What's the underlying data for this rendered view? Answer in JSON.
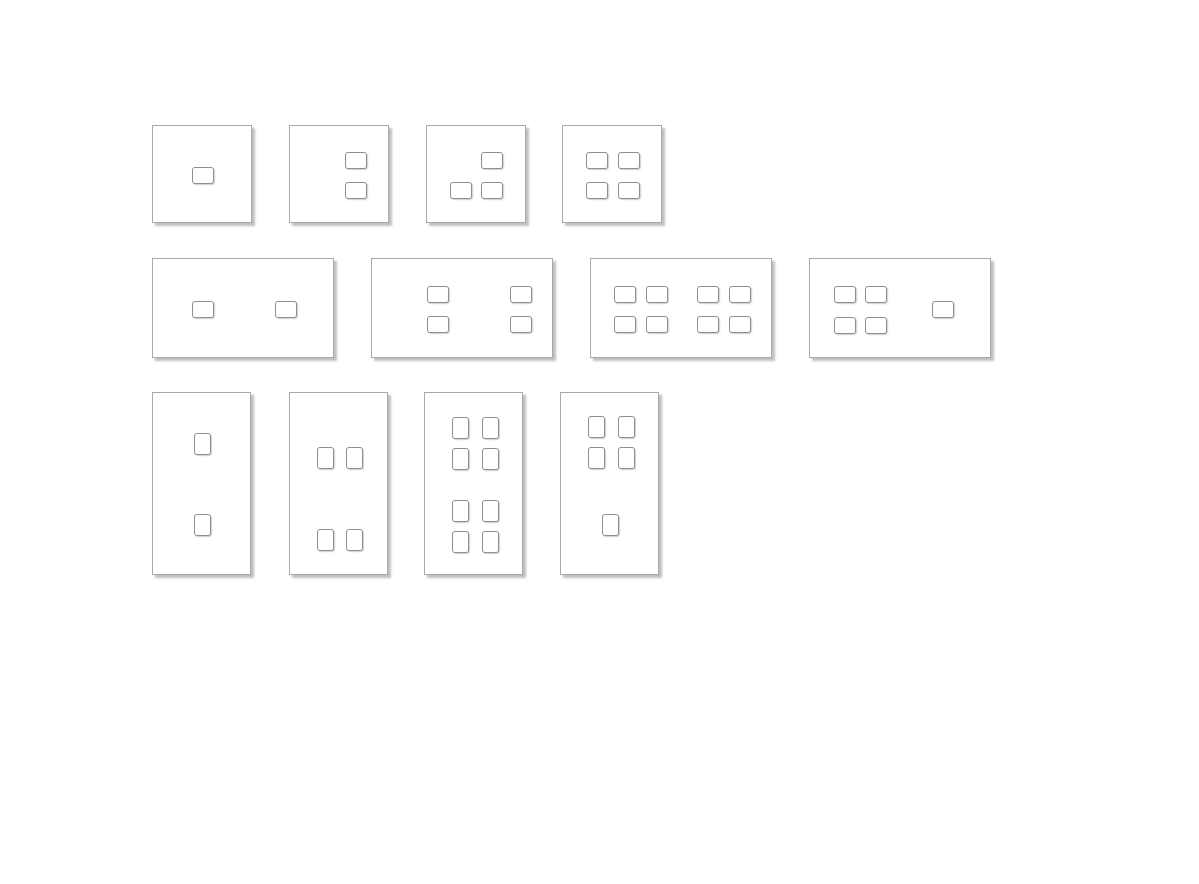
{
  "canvas": {
    "width": 1199,
    "height": 884,
    "background": "#ffffff",
    "description": "Twelve light-switch wall plates with push-button configurations arranged in three rows on a blank white canvas; no text visible"
  },
  "style": {
    "plate_fill": "#ffffff",
    "plate_border": "#a9a9a9",
    "plate_shadow": "rgba(130,130,130,0.5)",
    "button_fill": "#ffffff",
    "button_border": "#8f8f8f",
    "button_shadow": "rgba(160,160,160,0.5)"
  },
  "plates": [
    {
      "name": "plate-square-1-button",
      "row": 1,
      "x": 152,
      "y": 125,
      "w": 100,
      "h": 98,
      "button_w": 22,
      "button_h": 17,
      "buttons": [
        [
          39,
          41
        ]
      ]
    },
    {
      "name": "plate-square-2-buttons",
      "row": 1,
      "x": 289,
      "y": 125,
      "w": 100,
      "h": 98,
      "button_w": 22,
      "button_h": 17,
      "buttons": [
        [
          55,
          26
        ],
        [
          55,
          56
        ]
      ]
    },
    {
      "name": "plate-square-3-buttons",
      "row": 1,
      "x": 426,
      "y": 125,
      "w": 100,
      "h": 98,
      "button_w": 22,
      "button_h": 17,
      "buttons": [
        [
          54,
          26
        ],
        [
          23,
          56
        ],
        [
          54,
          56
        ]
      ]
    },
    {
      "name": "plate-square-4-buttons",
      "row": 1,
      "x": 562,
      "y": 125,
      "w": 100,
      "h": 98,
      "button_w": 22,
      "button_h": 17,
      "buttons": [
        [
          23,
          26
        ],
        [
          55,
          26
        ],
        [
          23,
          56
        ],
        [
          55,
          56
        ]
      ]
    },
    {
      "name": "plate-wide-2-buttons",
      "row": 2,
      "x": 152,
      "y": 258,
      "w": 182,
      "h": 100,
      "button_w": 22,
      "button_h": 17,
      "buttons": [
        [
          39,
          42
        ],
        [
          122,
          42
        ]
      ]
    },
    {
      "name": "plate-wide-4-buttons",
      "row": 2,
      "x": 371,
      "y": 258,
      "w": 182,
      "h": 100,
      "button_w": 22,
      "button_h": 17,
      "buttons": [
        [
          55,
          27
        ],
        [
          138,
          27
        ],
        [
          55,
          57
        ],
        [
          138,
          57
        ]
      ]
    },
    {
      "name": "plate-wide-8-buttons",
      "row": 2,
      "x": 590,
      "y": 258,
      "w": 182,
      "h": 100,
      "button_w": 22,
      "button_h": 17,
      "buttons": [
        [
          23,
          27
        ],
        [
          55,
          27
        ],
        [
          106,
          27
        ],
        [
          138,
          27
        ],
        [
          23,
          57
        ],
        [
          55,
          57
        ],
        [
          106,
          57
        ],
        [
          138,
          57
        ]
      ]
    },
    {
      "name": "plate-wide-5-buttons",
      "row": 2,
      "x": 809,
      "y": 258,
      "w": 182,
      "h": 100,
      "button_w": 22,
      "button_h": 17,
      "buttons": [
        [
          24,
          27
        ],
        [
          55,
          27
        ],
        [
          24,
          58
        ],
        [
          55,
          58
        ],
        [
          122,
          42
        ]
      ]
    },
    {
      "name": "plate-tall-2-buttons",
      "row": 3,
      "x": 152,
      "y": 392,
      "w": 99,
      "h": 183,
      "button_w": 17,
      "button_h": 22,
      "buttons": [
        [
          41,
          40
        ],
        [
          41,
          121
        ]
      ]
    },
    {
      "name": "plate-tall-4-buttons",
      "row": 3,
      "x": 289,
      "y": 392,
      "w": 99,
      "h": 183,
      "button_w": 17,
      "button_h": 22,
      "buttons": [
        [
          27,
          54
        ],
        [
          56,
          54
        ],
        [
          27,
          136
        ],
        [
          56,
          136
        ]
      ]
    },
    {
      "name": "plate-tall-8-buttons",
      "row": 3,
      "x": 424,
      "y": 392,
      "w": 99,
      "h": 183,
      "button_w": 17,
      "button_h": 22,
      "buttons": [
        [
          27,
          24
        ],
        [
          57,
          24
        ],
        [
          27,
          55
        ],
        [
          57,
          55
        ],
        [
          27,
          107
        ],
        [
          57,
          107
        ],
        [
          27,
          138
        ],
        [
          57,
          138
        ]
      ]
    },
    {
      "name": "plate-tall-5-buttons",
      "row": 3,
      "x": 560,
      "y": 392,
      "w": 99,
      "h": 183,
      "button_w": 17,
      "button_h": 22,
      "buttons": [
        [
          27,
          23
        ],
        [
          57,
          23
        ],
        [
          27,
          54
        ],
        [
          57,
          54
        ],
        [
          41,
          121
        ]
      ]
    }
  ]
}
